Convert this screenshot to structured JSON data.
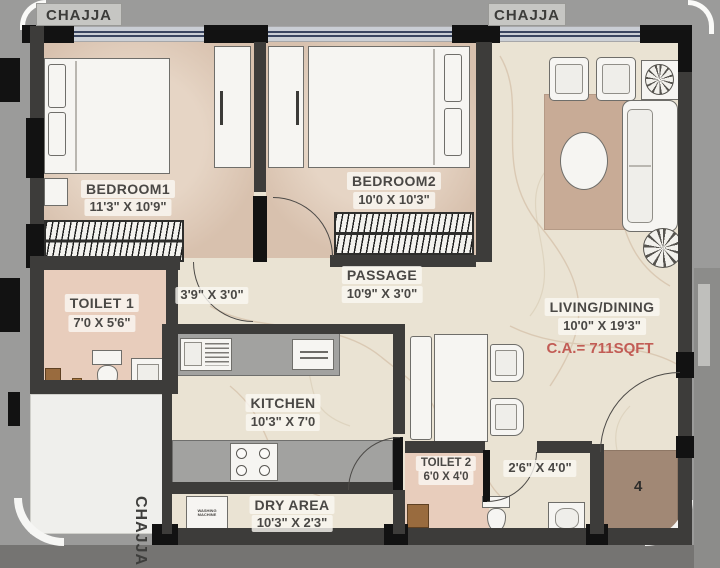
{
  "title": "Apartment Floor Plan",
  "chajja": {
    "top_left": "CHAJJA",
    "top_right": "CHAJJA",
    "bottom_left": "CHAJJA"
  },
  "rooms": {
    "bedroom1": {
      "name": "BEDROOM1",
      "dims": "11'3\" X 10'9\""
    },
    "bedroom2": {
      "name": "BEDROOM2",
      "dims": "10'0 X 10'3\""
    },
    "living": {
      "name": "LIVING/DINING",
      "dims": "10'0\" X 19'3\"",
      "carpet_area": "C.A.= 711SQFT"
    },
    "passage": {
      "name": "PASSAGE",
      "dims": "10'9\" X 3'0\""
    },
    "vestibule": {
      "dims": "3'9\" X 3'0\""
    },
    "toilet1": {
      "name": "TOILET 1",
      "dims": "7'0 X 5'6\""
    },
    "toilet2": {
      "name": "TOILET 2",
      "dims": "6'0 X 4'0"
    },
    "kitchen": {
      "name": "KITCHEN",
      "dims": "10'3\" X 7'0"
    },
    "dry_area": {
      "name": "DRY AREA",
      "dims": "10'3\" X 2'3\""
    },
    "foyer": {
      "dims": "2'6\" X 4'0\""
    }
  },
  "labels": {
    "entrance_unit": "4",
    "washing_machine": "WASHING MACHINE"
  },
  "colors": {
    "wall": "#3d3c3a",
    "window_frame": "#39445f",
    "floor_marble": "#eae3d3",
    "bedroom_floor": "#d8c1ae",
    "toilet_floor": "#e8cdbc",
    "rug": "#c8ab96",
    "entrance_pad": "#a18875",
    "carpet_area_text": "#c25c55",
    "outside": "#9b9b9a"
  }
}
